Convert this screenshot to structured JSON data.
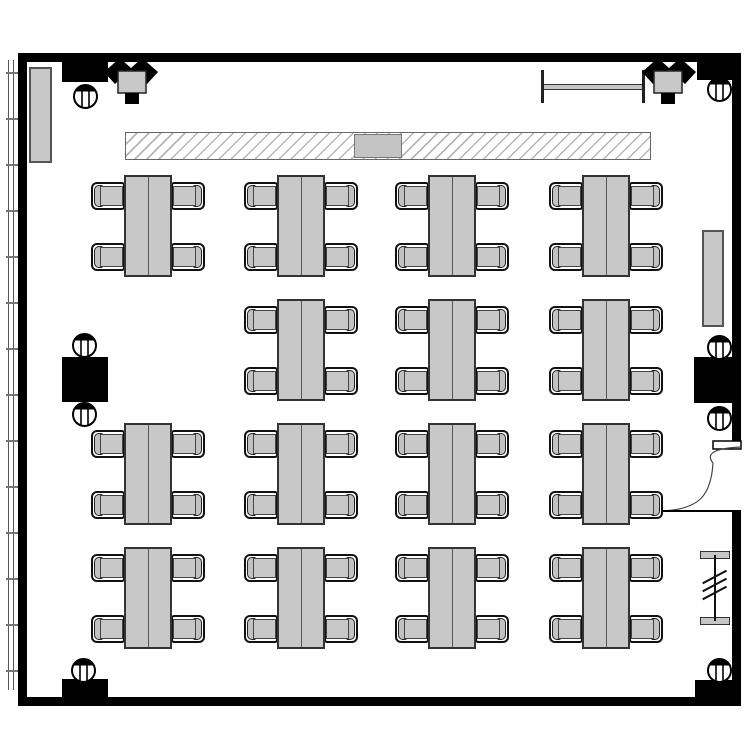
{
  "plan": {
    "name": "classroom-floor-plan",
    "canvas": {
      "width": 750,
      "height": 750,
      "background": "#ffffff"
    },
    "colors": {
      "wall": "#000000",
      "furniture_fill": "#c8c8c8",
      "furniture_border": "#333333",
      "line": "#444444"
    },
    "walls": [
      {
        "name": "wall-top",
        "x": 18,
        "y": 53,
        "w": 723,
        "h": 9
      },
      {
        "name": "wall-left",
        "x": 18,
        "y": 53,
        "w": 9,
        "h": 653
      },
      {
        "name": "wall-bottom",
        "x": 18,
        "y": 697,
        "w": 723,
        "h": 9
      },
      {
        "name": "wall-right-above-door",
        "x": 732,
        "y": 53,
        "w": 9,
        "h": 390
      },
      {
        "name": "wall-right-below-door",
        "x": 732,
        "y": 511,
        "w": 9,
        "h": 195
      }
    ],
    "window_band": {
      "x": 8,
      "y": 60,
      "w": 6,
      "h": 630,
      "tick_start": 72,
      "tick_spacing": 46,
      "tick_count": 14,
      "tick_w": 12
    },
    "piers": [
      {
        "name": "wall-pier-top-left",
        "x": 62,
        "y": 62,
        "w": 46,
        "h": 20
      },
      {
        "name": "corner-block-top-right",
        "x": 697,
        "y": 62,
        "w": 44,
        "h": 18
      },
      {
        "name": "column-block-left",
        "x": 62,
        "y": 357,
        "w": 46,
        "h": 45
      },
      {
        "name": "column-block-right",
        "x": 694,
        "y": 357,
        "w": 47,
        "h": 46
      },
      {
        "name": "wall-pier-bottom-left",
        "x": 62,
        "y": 679,
        "w": 46,
        "h": 18
      },
      {
        "name": "corner-block-bottom-right",
        "x": 695,
        "y": 680,
        "w": 46,
        "h": 17
      }
    ],
    "columns": [
      {
        "cx": 85,
        "cy": 96
      },
      {
        "cx": 719,
        "cy": 89
      },
      {
        "cx": 84,
        "cy": 345
      },
      {
        "cx": 84,
        "cy": 414
      },
      {
        "cx": 719,
        "cy": 347
      },
      {
        "cx": 719,
        "cy": 418
      },
      {
        "cx": 83,
        "cy": 670
      },
      {
        "cx": 719,
        "cy": 670
      }
    ],
    "column_radius": 11.5,
    "radiators": [
      {
        "name": "radiator-left",
        "x": 29,
        "y": 67,
        "w": 23,
        "h": 96
      },
      {
        "name": "radiator-right",
        "x": 702,
        "y": 230,
        "w": 22,
        "h": 97
      }
    ],
    "board": {
      "x": 125,
      "y": 132,
      "w": 526,
      "h": 28,
      "panel": {
        "x": 354,
        "y": 134,
        "w": 48,
        "h": 24
      }
    },
    "screen_rail": {
      "x1": 542,
      "x2": 644,
      "bar_y": 84,
      "bar_h": 6,
      "cap_top": 70,
      "cap_h": 33,
      "cap_w": 3
    },
    "corner_devices": [
      {
        "name": "corner-projector-top-left",
        "x": 103,
        "y": 57,
        "mirror": false
      },
      {
        "name": "corner-projector-top-right",
        "x": 641,
        "y": 57,
        "mirror": true
      }
    ],
    "door": {
      "name": "door-right",
      "gap_top": 443,
      "gap_bottom": 511,
      "jamb": {
        "x": 713,
        "y": 441,
        "w": 28,
        "h": 8
      },
      "hook_path": "M 741 447 C 719 448 704 452 713 463",
      "leaf_path": "M 713 463 C 711 496 699 509 663 511",
      "base_line": {
        "x1": 663,
        "y1": 511,
        "x2": 741,
        "y2": 511
      }
    },
    "coat_rack": {
      "name": "coat-rack",
      "bar_x": 700,
      "bar_w": 30,
      "bar_h": 8,
      "top_y": 551,
      "bottom_y": 617,
      "line_x": 714,
      "line_w": 2,
      "hash_x": 701,
      "hash_w": 27,
      "hash_ys": [
        576,
        584,
        592
      ]
    },
    "table_spec": {
      "w": 48,
      "h": 102,
      "chair_w": 34,
      "chair_h": 28,
      "chair_top_offset": 7,
      "chair_bottom_offset": 6,
      "chair_overlap": 1,
      "chairs_per_table": 4
    },
    "tables": [
      {
        "x": 124,
        "y": 175
      },
      {
        "x": 277,
        "y": 175
      },
      {
        "x": 428,
        "y": 175
      },
      {
        "x": 582,
        "y": 175
      },
      {
        "x": 277,
        "y": 299
      },
      {
        "x": 428,
        "y": 299
      },
      {
        "x": 582,
        "y": 299
      },
      {
        "x": 124,
        "y": 423
      },
      {
        "x": 277,
        "y": 423
      },
      {
        "x": 428,
        "y": 423
      },
      {
        "x": 582,
        "y": 423
      },
      {
        "x": 124,
        "y": 547
      },
      {
        "x": 277,
        "y": 547
      },
      {
        "x": 428,
        "y": 547
      },
      {
        "x": 582,
        "y": 547
      }
    ]
  }
}
